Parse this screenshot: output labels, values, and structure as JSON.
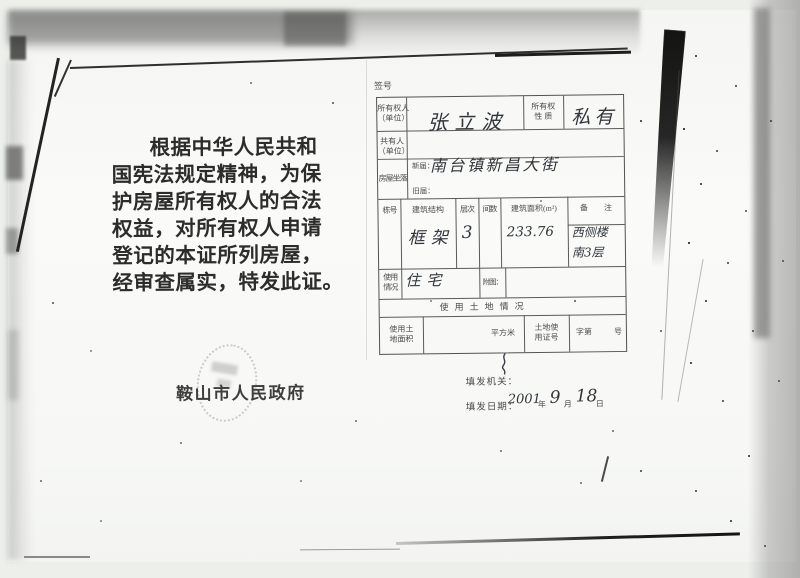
{
  "doc": {
    "lines": [
      "根据中华人民共和",
      "国宪法规定精神，为保",
      "护房屋所有权人的合法",
      "权益，对所有权人申请",
      "登记的本证所列房屋，",
      "经审查属实，特发此证。"
    ],
    "issuer": "鞍山市人民政府"
  },
  "form": {
    "serial_label": "签号",
    "owner": {
      "label1": "所有权人",
      "label2": "（单位）",
      "value": "张立波"
    },
    "nature": {
      "label1": "所有权",
      "label2": "性 质",
      "value": "私有"
    },
    "co_owner": {
      "label1": "共有人",
      "label2": "（单位）",
      "value": ""
    },
    "location": {
      "label": "房屋坐落",
      "new_label": "新届：",
      "new_value": "南台镇新昌大街",
      "old_label": "旧届：",
      "old_value": ""
    },
    "building_table": {
      "headers": {
        "no": "栋号",
        "structure": "建筑结构",
        "floors": "层次",
        "rooms": "间数",
        "area": "建筑面积(m²)",
        "remark": "备 注"
      },
      "values": {
        "no": "",
        "structure": "框架",
        "floors": "3",
        "rooms": "",
        "area": "233.76",
        "remark1": "西侧楼",
        "remark2": "南3层"
      }
    },
    "usage": {
      "label1": "使用",
      "label2": "情况",
      "value": "住宅",
      "attach_label": "附图："
    },
    "land_title": "使用土地情况",
    "land_row": {
      "area_label1": "使用土",
      "area_label2": "地面积",
      "unit": "平方米",
      "cert_label1": "土地使",
      "cert_label2": "用证号",
      "no_prefix": "字第",
      "no_suffix": "号"
    },
    "issue_org_label": "填发机关：",
    "issue_date_label": "填发日期：",
    "issue_date": {
      "year_hw": "2001",
      "year": "年",
      "month_hw": "9",
      "month": "月",
      "day_hw": "18",
      "day": "日"
    }
  }
}
